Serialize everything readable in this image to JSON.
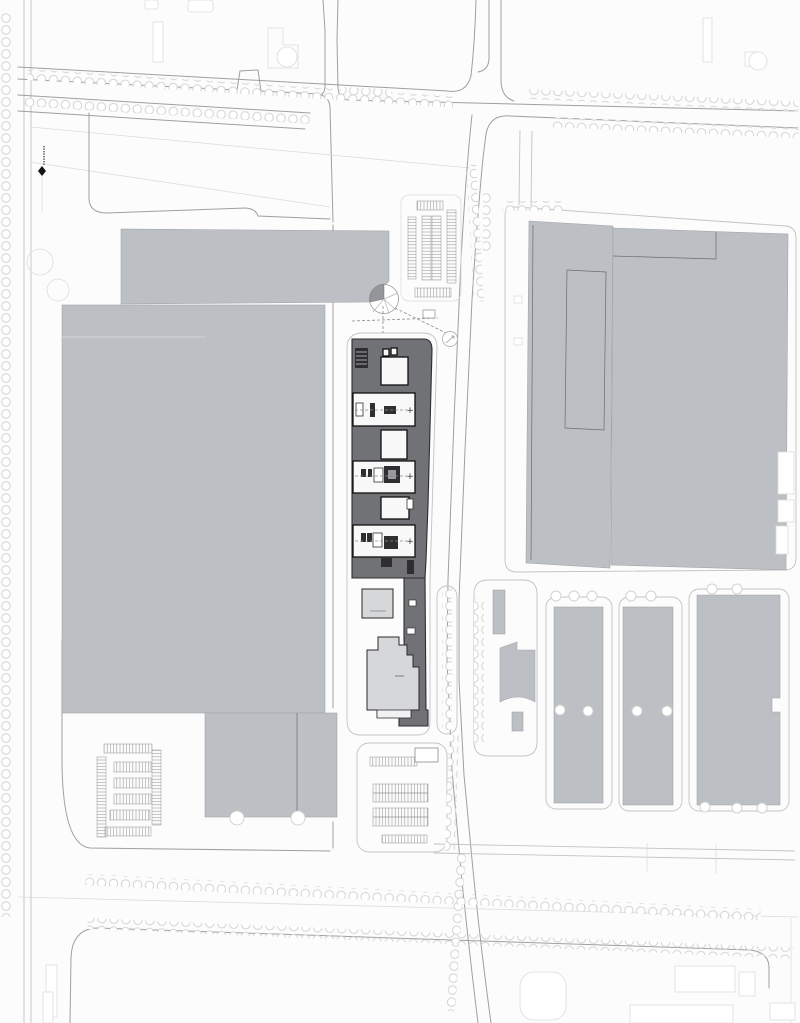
{
  "palette": {
    "paper": "#fcfcfc",
    "building_gray": "#bcbfc3",
    "building_gray_edge": "#a2a5a9",
    "plinth": "#717276",
    "plinth_edge": "#2e2e30",
    "white_building": "#f8f8f8",
    "white_building_edge": "#101010",
    "light_building": "#d6d7d9",
    "light_building_edge": "#2a2a2a",
    "dark_fill": "#2f2f31",
    "road_line": "#9f9fa0",
    "mid_line": "#c3c3c4",
    "faint_line": "#dcdcdd",
    "tree_line": "#d3d3d4",
    "hatch_line": "#9b9b9c",
    "dashed_line": "#8a8a8b"
  },
  "symbols": {
    "target_cross": "+"
  },
  "features": {
    "left_campus": "left-campus-buildings",
    "central_strip": "central-plinth-district",
    "right_campus": "right-campus-building",
    "southeast_lots": "southeast-warehouse-bars",
    "parking": "hatched-parking-lots",
    "survey_marker": "survey-marker"
  }
}
